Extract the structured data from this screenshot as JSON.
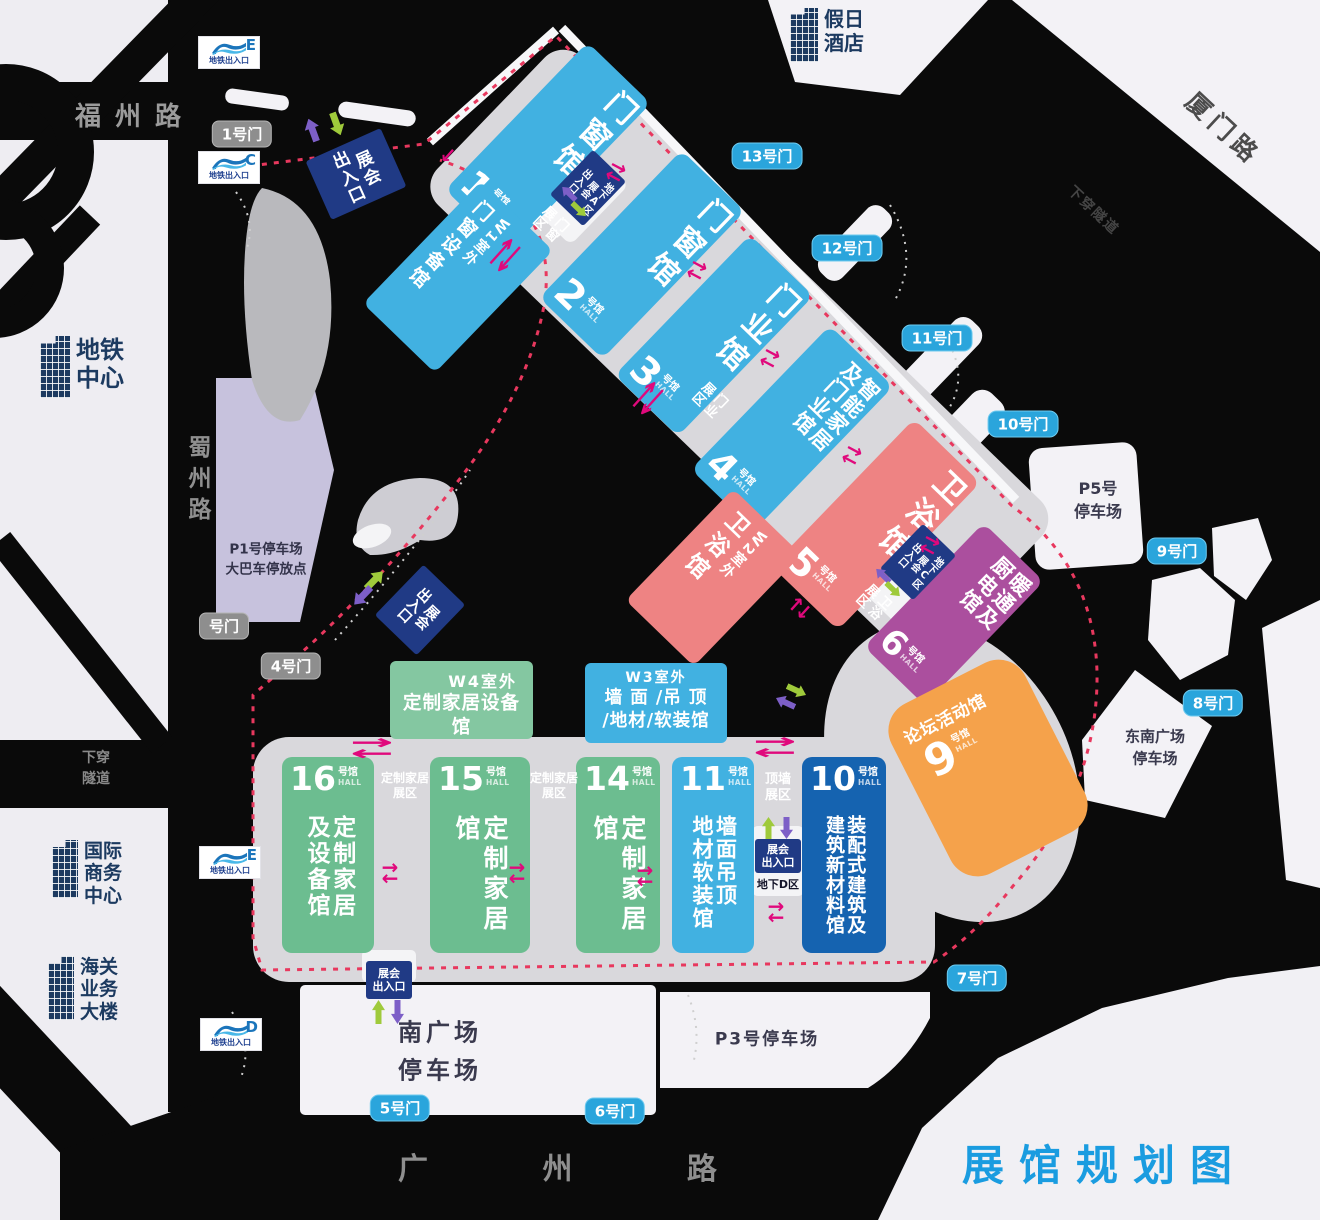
{
  "title": "展馆规划图",
  "colors": {
    "hall_blue": "#41b1e1",
    "hall_navy": "#1563b0",
    "hall_pink": "#ee8383",
    "hall_purple": "#ab4f9e",
    "hall_green": "#6cbd90",
    "hall_orange": "#f5a24b",
    "gate_blue": "#2aa5dc",
    "gate_gray": "#8e8e8e",
    "entrance_navy": "#203a85",
    "route_dashed": "#e8385e",
    "flow_arrow": "#e0097c",
    "title_blue": "#1a9ce0"
  },
  "roads": {
    "fuzhou": "福州路",
    "shuzhou": "蜀州路",
    "xiamen": "厦门路",
    "guangzhou": "广  州  路",
    "tunnel": "下穿隧道",
    "tunnel2": [
      "下穿",
      "隧道"
    ]
  },
  "buildings": {
    "hotel": [
      "假日",
      "酒店"
    ],
    "metro_center": [
      "地铁",
      "中心"
    ],
    "intl_business": [
      "国际",
      "商务",
      "中心"
    ],
    "customs": [
      "海关",
      "业务",
      "大楼"
    ]
  },
  "halls": [
    {
      "num": "1",
      "suffix": "号馆",
      "en": "HALL",
      "name": [
        "门窗馆"
      ]
    },
    {
      "num": "2",
      "suffix": "号馆",
      "en": "HALL",
      "name": [
        "门窗馆"
      ]
    },
    {
      "num": "3",
      "suffix": "号馆",
      "en": "HALL",
      "name": [
        "门业馆"
      ]
    },
    {
      "num": "4",
      "suffix": "号馆",
      "en": "HALL",
      "name": [
        "智能家居",
        "及门业馆"
      ]
    },
    {
      "num": "5",
      "suffix": "号馆",
      "en": "HALL",
      "name": [
        "卫浴馆"
      ]
    },
    {
      "num": "6",
      "suffix": "号馆",
      "en": "HALL",
      "name": [
        "暖通及",
        "厨电馆"
      ]
    },
    {
      "num": "16",
      "suffix": "号馆",
      "en": "HALL",
      "name": [
        "定制家居",
        "及设备馆"
      ]
    },
    {
      "num": "15",
      "suffix": "号馆",
      "en": "HALL",
      "name": [
        "定制家居馆"
      ]
    },
    {
      "num": "14",
      "suffix": "号馆",
      "en": "HALL",
      "name": [
        "定制家居馆"
      ]
    },
    {
      "num": "11",
      "suffix": "号馆",
      "en": "HALL",
      "name": [
        "墙面吊顶",
        "地材软装馆"
      ]
    },
    {
      "num": "10",
      "suffix": "号馆",
      "en": "HALL",
      "name": [
        "装配式建筑及",
        "建筑新材料馆"
      ]
    }
  ],
  "outdoor_halls": {
    "w1": {
      "head": "W1室外",
      "name": "门窗设备馆"
    },
    "w2": {
      "head": "W2室外",
      "name": "卫浴馆"
    },
    "w3": {
      "head": "W3室外",
      "lines": [
        "墙 面 /吊 顶",
        "/地材/软装馆"
      ]
    },
    "w4": {
      "head": "W4室外",
      "name": "定制家居设备馆"
    }
  },
  "forum": {
    "name": "论坛活动馆",
    "num": "9",
    "suffix": "号馆",
    "en": "HALL"
  },
  "zones": {
    "window": [
      "门窗",
      "展区"
    ],
    "door": [
      "门业",
      "展区"
    ],
    "bath": [
      "卫浴",
      "展区"
    ],
    "custom": [
      "定制家居",
      "展区"
    ],
    "ceiling": [
      "顶墙",
      "展区"
    ]
  },
  "gates": {
    "g1": "1号门",
    "gx": "号门",
    "g4": "4号门",
    "g5": "5号门",
    "g6": "6号门",
    "g7": "7号门",
    "g8": "8号门",
    "g9": "9号门",
    "g10": "10号门",
    "g11": "11号门",
    "g12": "12号门",
    "g13": "13号门"
  },
  "entrances": {
    "main": [
      "展会",
      "出入口"
    ],
    "area_a": [
      "地下A区",
      "展会",
      "出入口"
    ],
    "area_c": [
      "地下C区",
      "展会",
      "出入口"
    ],
    "area_d_label": "地下D区"
  },
  "metro": {
    "label": "地铁出入口",
    "exit_e_top": "E",
    "exit_c": "C",
    "exit_e_south": "E",
    "exit_d": "D"
  },
  "parking": {
    "p1": [
      "P1号停车场",
      "大巴车停放点"
    ],
    "p5": [
      "P5号",
      "停车场"
    ],
    "southeast": [
      "东南广场",
      "停车场"
    ],
    "south": [
      "南广场",
      "停车场"
    ],
    "p3": "P3号停车场"
  },
  "icons": {
    "arrow_right": "→",
    "arrow_left": "←"
  }
}
